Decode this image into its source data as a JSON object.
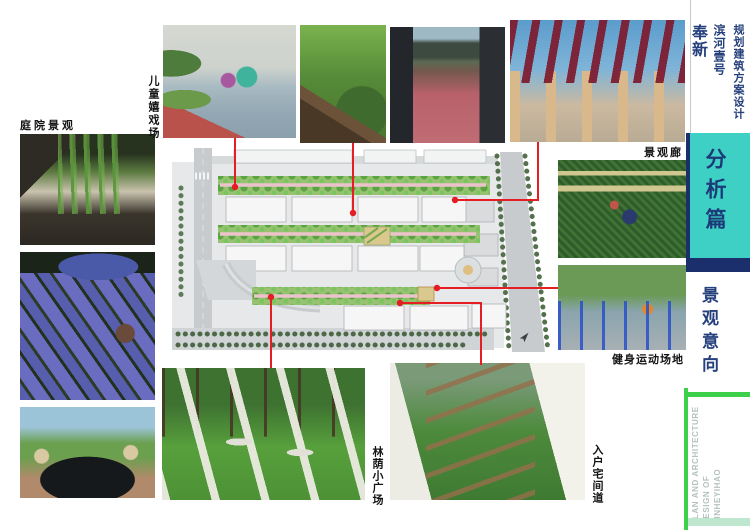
{
  "photo_labels": {
    "children_play": "儿童嬉戏场",
    "courtyard": "庭院景观",
    "gallery": "景观廊",
    "fitness": "健身运动场地",
    "shade_plaza": "林荫小广场",
    "entry_path": "入户宅间道"
  },
  "sidebar": {
    "location": "奉新",
    "project": "滨河壹号",
    "subtitle": "规划建筑方案设计",
    "section": "分析篇",
    "chapter": "景观意向",
    "english_lines": [
      "PLAN AND ARCHITECTURE",
      "DESIGN OF",
      "BINHEYIHAO"
    ]
  },
  "colors": {
    "accent_cyan": "#3ed0c4",
    "accent_navy": "#1c2f6d",
    "accent_green": "#3dd14b",
    "pale_green": "#bfe7d0",
    "callout_red": "#e61d23",
    "text_navy": "#25407c"
  }
}
